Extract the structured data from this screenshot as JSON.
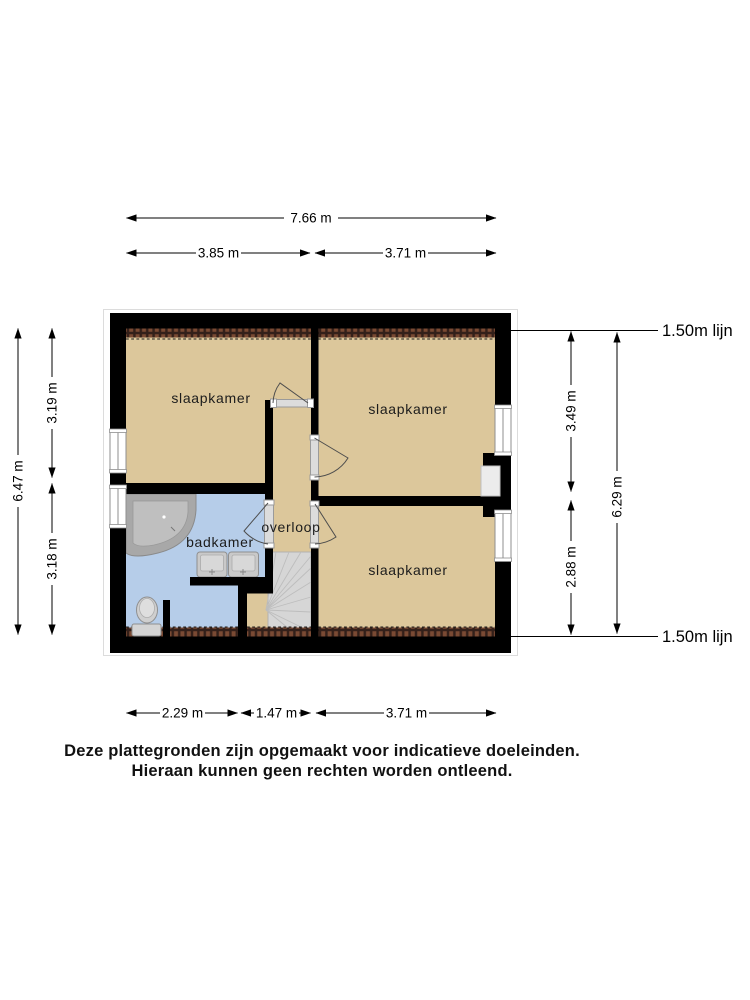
{
  "rooms": {
    "bedroom_top_left": "slaapkamer",
    "bedroom_top_right": "slaapkamer",
    "bedroom_bottom_right": "slaapkamer",
    "bathroom": "badkamer",
    "landing": "overloop"
  },
  "dimensions": {
    "top": {
      "total": "7.66 m",
      "left_section": "3.85 m",
      "right_section": "3.71 m"
    },
    "bottom": {
      "left_section": "2.29 m",
      "middle_section": "1.47 m",
      "right_section": "3.71 m"
    },
    "left": {
      "total": "6.47 m",
      "top_section": "3.19 m",
      "bottom_section": "3.18 m"
    },
    "right": {
      "total": "6.29 m",
      "top_section": "3.49 m",
      "bottom_section": "2.88 m"
    },
    "height_line_top": "1.50m lijn",
    "height_line_bottom": "1.50m lijn"
  },
  "disclaimer": {
    "line1": "Deze plattegronden zijn opgemaakt voor indicatieve doeleinden.",
    "line2": "Hieraan kunnen geen rechten worden ontleend."
  },
  "colors": {
    "floor": "#dcc79b",
    "bathroom_floor": "#b6cde9",
    "wall": "#000000",
    "attic_hatch_brick": "#7a4a33",
    "stairs": "#d6d6d6",
    "fixture_gray": "#c9c9c9"
  },
  "fixture_icons": [
    "bathtub-icon",
    "double-sink-icon",
    "toilet-icon",
    "staircase-icon",
    "door-icon",
    "window-icon",
    "chimney-icon"
  ]
}
